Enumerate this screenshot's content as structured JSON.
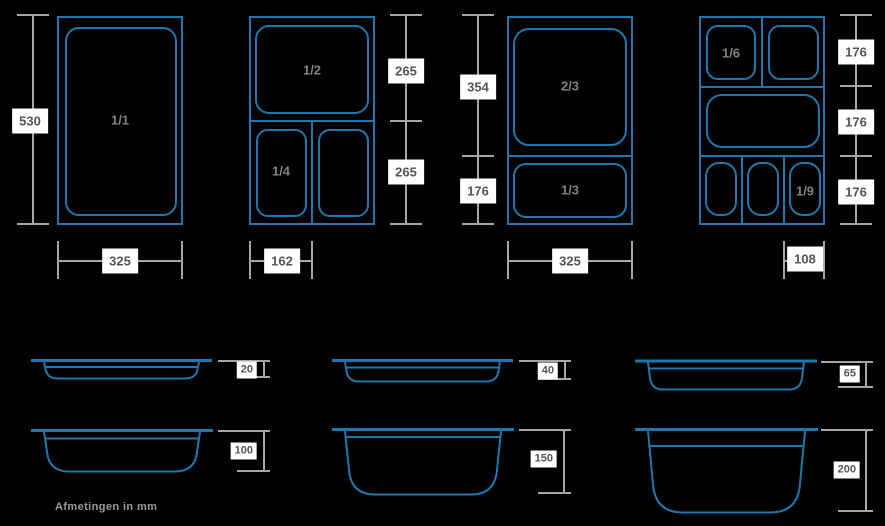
{
  "note": "Afmetingen in mm",
  "colors": {
    "background": "#000000",
    "outline_blue": "#1E78AC",
    "dimension_gray": "#A6A6A6",
    "label_box_background": "#FFFFFF",
    "label_box_text": "#555555",
    "pan_fraction_text": "#828282"
  },
  "diagrams": [
    {
      "labels": {
        "pan1": "1/1"
      },
      "dims": {
        "h1": "530",
        "w": "325"
      }
    },
    {
      "labels": {
        "pan1": "1/2",
        "pan2": "1/4"
      },
      "dims": {
        "h1": "265",
        "h2": "265",
        "w": "162"
      }
    },
    {
      "labels": {
        "pan1": "2/3",
        "pan2": "1/3"
      },
      "dims": {
        "h1": "354",
        "h2": "176",
        "w": "325"
      }
    },
    {
      "labels": {
        "pan1": "1/6",
        "pan2": "1/9"
      },
      "dims": {
        "h1": "176",
        "h2": "176",
        "h3": "176",
        "w": "108"
      }
    }
  ],
  "depths": [
    {
      "label": "20"
    },
    {
      "label": "40"
    },
    {
      "label": "65"
    },
    {
      "label": "100"
    },
    {
      "label": "150"
    },
    {
      "label": "200"
    }
  ]
}
